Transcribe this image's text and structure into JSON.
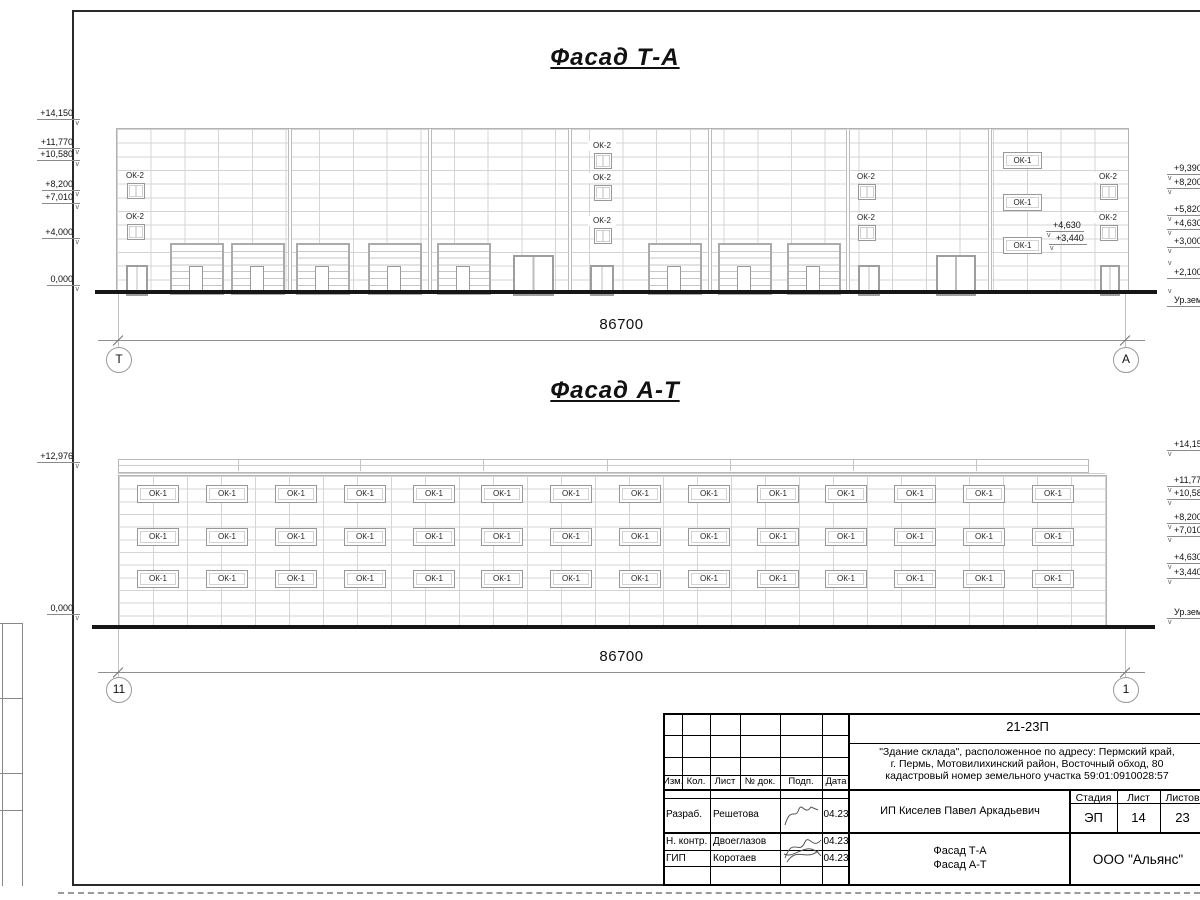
{
  "labels": {
    "ok1": "ОК-1",
    "ok2": "ОК-2"
  },
  "facade_top": {
    "title": "Фасад Т-А",
    "dim": "86700",
    "axes": [
      {
        "label": "Т",
        "x": 118
      },
      {
        "label": "А",
        "x": 1125
      }
    ],
    "box": {
      "x": 116,
      "y": 128,
      "w": 1011,
      "h": 164
    },
    "joints": [
      290,
      430,
      570,
      710,
      848,
      990
    ],
    "ok2": [
      {
        "x": 127,
        "y": 183
      },
      {
        "x": 127,
        "y": 224
      },
      {
        "x": 594,
        "y": 153
      },
      {
        "x": 594,
        "y": 185
      },
      {
        "x": 594,
        "y": 228
      },
      {
        "x": 858,
        "y": 184
      },
      {
        "x": 858,
        "y": 225
      },
      {
        "x": 1100,
        "y": 184
      },
      {
        "x": 1100,
        "y": 225
      }
    ],
    "ok1": [
      {
        "x": 1003,
        "y": 152
      },
      {
        "x": 1003,
        "y": 194
      },
      {
        "x": 1003,
        "y": 237
      }
    ],
    "garage_doors": [
      170,
      231,
      296,
      368,
      437,
      648,
      718,
      787
    ],
    "doors": [
      {
        "x": 126,
        "w": 18
      },
      {
        "x": 590,
        "w": 20
      },
      {
        "x": 858,
        "w": 18
      },
      {
        "x": 1100,
        "w": 16
      }
    ],
    "double_doors": [
      {
        "x": 513,
        "w": 37
      },
      {
        "x": 936,
        "w": 36
      }
    ],
    "inline_marks": [
      {
        "text": "+4,630",
        "x": 1046,
        "y": 220
      },
      {
        "text": "+3,440",
        "x": 1049,
        "y": 233
      }
    ],
    "marks_left": [
      {
        "text": "+14,150",
        "y": 108
      },
      {
        "text": "+11,770",
        "y": 137
      },
      {
        "text": "+10,580",
        "y": 149
      },
      {
        "text": "+8,200",
        "y": 179
      },
      {
        "text": "+7,010",
        "y": 192
      },
      {
        "text": "+4,000",
        "y": 227
      },
      {
        "text": "0,000",
        "y": 274
      }
    ],
    "marks_right": [
      {
        "text": "+9,390",
        "y": 163
      },
      {
        "text": "+8,200",
        "y": 177
      },
      {
        "text": "+5,820",
        "y": 204
      },
      {
        "text": "+4,630",
        "y": 218
      },
      {
        "text": "+3,000",
        "y": 236
      },
      {
        "text": "+2,100",
        "y": 267,
        "flip": true
      },
      {
        "text": "Ур.земли",
        "y": 295,
        "flip": true
      }
    ],
    "ground": {
      "x": 95,
      "y": 290,
      "w": 1062
    },
    "dim_geom": {
      "y": 340,
      "ty": 316,
      "x1": 118,
      "x2": 1125,
      "cy": 359
    }
  },
  "facade_bottom": {
    "title": "Фасад А-Т",
    "dim": "86700",
    "axes": [
      {
        "label": "11",
        "x": 118
      },
      {
        "label": "1",
        "x": 1125
      }
    ],
    "box": {
      "x": 118,
      "y": 459,
      "w": 987,
      "h": 168
    },
    "parapet_joints": [
      238,
      360,
      483,
      607,
      730,
      853,
      976
    ],
    "ok1_rows": [
      485,
      528,
      570
    ],
    "ok1_cols": [
      137,
      206,
      275,
      344,
      413,
      481,
      550,
      619,
      688,
      757,
      825,
      894,
      963,
      1032
    ],
    "marks_left": [
      {
        "text": "+12,976",
        "y": 451
      },
      {
        "text": "0,000",
        "y": 603
      }
    ],
    "marks_right": [
      {
        "text": "+14,150",
        "y": 439
      },
      {
        "text": "+11,770",
        "y": 475
      },
      {
        "text": "+10,580",
        "y": 488
      },
      {
        "text": "+8,200",
        "y": 512
      },
      {
        "text": "+7,010",
        "y": 525
      },
      {
        "text": "+4,630",
        "y": 552
      },
      {
        "text": "+3,440",
        "y": 567
      },
      {
        "text": "Ур.земли",
        "y": 607
      }
    ],
    "ground": {
      "x": 92,
      "y": 625,
      "w": 1063
    },
    "dim_geom": {
      "y": 672,
      "ty": 648,
      "x1": 118,
      "x2": 1125,
      "cy": 689
    }
  },
  "title_block": {
    "code": "21-23П",
    "description": [
      "\"Здание склада\", расположенное по адресу: Пермский край,",
      "г. Пермь, Мотовилихинский район, Восточный обход, 80",
      "кадастровый номер земельного участка 59:01:0910028:57"
    ],
    "cols": {
      "izm": "Изм.",
      "kol": "Кол.",
      "list": "Лист",
      "ndok": "№ док.",
      "podp": "Подп.",
      "data": "Дата"
    },
    "rows": [
      {
        "role": "Разраб.",
        "name": "Решетова",
        "date": "04.23"
      },
      {
        "role": "Н. контр.",
        "name": "Двоеглазов",
        "date": "04.23"
      },
      {
        "role": "ГИП",
        "name": "Коротаев",
        "date": "04.23"
      }
    ],
    "client": "ИП Киселев Павел Аркадьевич",
    "stage": {
      "label": "Стадия",
      "value": "ЭП"
    },
    "sheet": {
      "label": "Лист",
      "value": "14"
    },
    "sheets": {
      "label": "Листов",
      "value": "23"
    },
    "doc_name": [
      "Фасад Т-А",
      "Фасад А-Т"
    ],
    "company": "ООО \"Альянс\""
  }
}
